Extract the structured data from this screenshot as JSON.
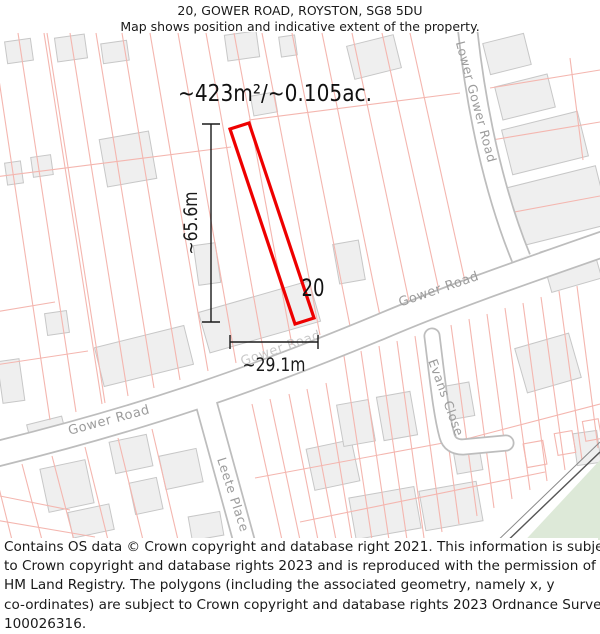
{
  "header": {
    "title": "20, GOWER ROAD, ROYSTON, SG8 5DU",
    "subtitle": "Map shows position and indicative extent of the property."
  },
  "map": {
    "area_label": "~423m²/~0.105ac.",
    "plot_number": "20",
    "dimensions": {
      "height_label": "~65.6m",
      "width_label": "~29.1m"
    },
    "roads": {
      "gower_left": "Gower Road",
      "gower_mid": "Gower Road",
      "gower_right": "Gower Road",
      "lower_gower": "Lower Gower Road",
      "evans_close": "Evans Close",
      "leete_place": "Leete Place"
    }
  },
  "colors": {
    "property_outline": "#ee0000",
    "parcel_line": "#f4b6af",
    "building_fill": "#efefef",
    "building_stroke": "#c7c7c7",
    "road_casing": "#bdbdbd",
    "road_fill": "#ffffff",
    "road_label": "#9c9c9c",
    "road_label_faint": "#c8c8c8",
    "dimension": "#1a1a1a",
    "green_area": "#dde9d8",
    "railway_dark": "#555555",
    "railway_light": "#8a8a8a"
  },
  "footer": {
    "lines": [
      "Contains OS data © Crown copyright and database right 2021. This information is subject",
      "to Crown copyright and database rights 2023 and is reproduced with the permission of",
      "HM Land Registry. The polygons (including the associated geometry, namely x, y",
      "co-ordinates) are subject to Crown copyright and database rights 2023 Ordnance Survey",
      "100026316."
    ]
  }
}
